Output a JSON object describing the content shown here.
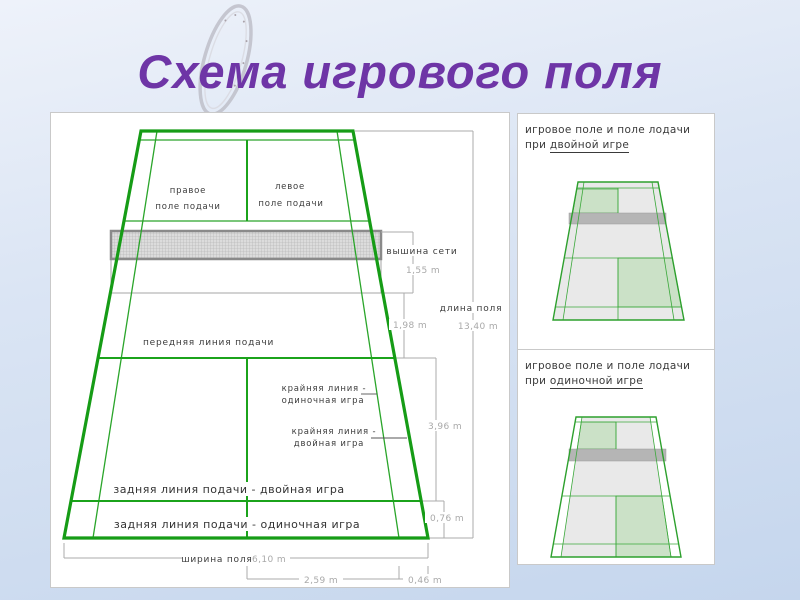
{
  "slide": {
    "title": "Схема игрового поля"
  },
  "colors": {
    "title_purple": "#6e35a6",
    "court_line_green": "#169c16",
    "dimension_gray": "#ababab",
    "label_dark": "#3c3c3c",
    "net_fill_gray": "#dcdcdc",
    "net_border_gray": "#8a8a8a",
    "mini_court_fill": "#e9e9e9",
    "mini_service_green": "#cbe1c7"
  },
  "main_diagram": {
    "labels": {
      "right_service_1": "правое",
      "right_service_2": "поле  подачи",
      "left_service_1": "левое",
      "left_service_2": "поле  подачи",
      "front_service_line": "передняя  линия  подачи",
      "singles_side_1": "крайняя  линия  -",
      "singles_side_2": "одиночная  игра",
      "doubles_side_1": "крайняя  линия  -",
      "doubles_side_2": "двойная  игра",
      "back_line_doubles": "задняя  линия  подачи  -  двойная  игра",
      "back_line_singles": "задняя  линия  подачи  -  одиночная  игра",
      "net_height": "вышина  сети",
      "field_length": "длина  поля",
      "field_width": "ширина  поля"
    },
    "measurements": {
      "net_height": "1,55 m",
      "net_to_front_line": "1,98 m",
      "field_length": "13,40 m",
      "front_to_back_doubles": "3,96 m",
      "doubles_line_to_back": "0,76 m",
      "field_width": "6,10 m",
      "center_to_singles_side": "2,59 m",
      "singles_side_inset": "0,46 m"
    }
  },
  "side_panels": [
    {
      "title": "игровое  поле  и  поле  лодачи",
      "subtitle_prefix": "при ",
      "subtitle_underlined": "двойной  игре"
    },
    {
      "title": "игровое  поле  и  поле  лодачи",
      "subtitle_prefix": "при ",
      "subtitle_underlined": "одиночной  игре"
    }
  ]
}
